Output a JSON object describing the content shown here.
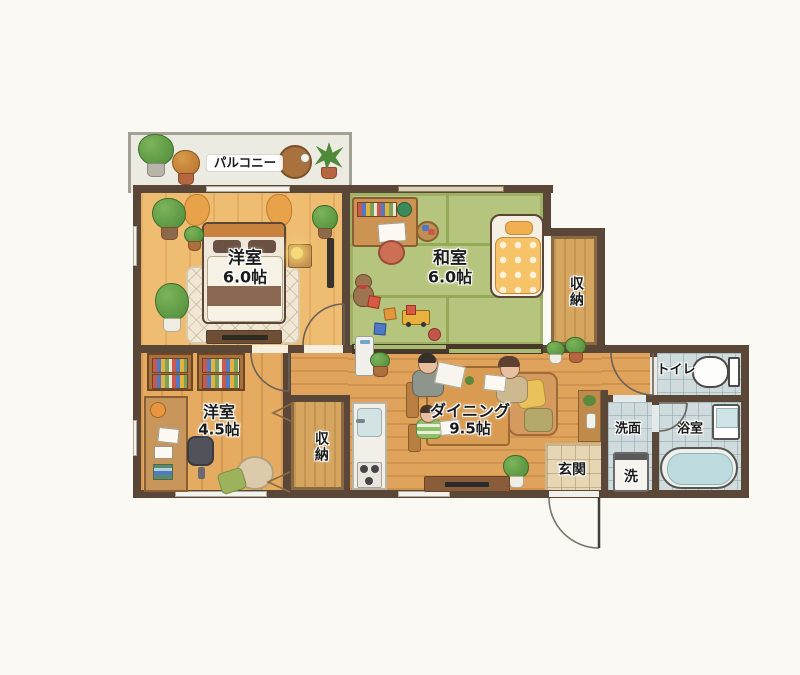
{
  "rooms": {
    "balcony": {
      "label": "パルコニー"
    },
    "bedroom": {
      "label": "洋室",
      "size": "6.0帖"
    },
    "washitsu": {
      "label": "和室",
      "size": "6.0帖"
    },
    "closet_upper": {
      "label": "収納"
    },
    "western_room": {
      "label": "洋室",
      "size": "4.5帖"
    },
    "closet_lower": {
      "label": "収納"
    },
    "dining": {
      "label": "ダイニング",
      "size": "9.5帖"
    },
    "entrance": {
      "label": "玄関"
    },
    "toilet": {
      "label": "トイレ"
    },
    "washroom": {
      "label": "洗面"
    },
    "washer": {
      "label": "洗"
    },
    "bathroom": {
      "label": "浴室"
    }
  },
  "colors": {
    "wall": "#5a4737",
    "wood_floor": "#dfa35b",
    "bedroom_floor": "#eebd72",
    "tatami": "#b6c57d",
    "tile": "#cfdbdc",
    "genkan_tile": "#e6d6b4",
    "tatami_line": "#95aa58"
  }
}
